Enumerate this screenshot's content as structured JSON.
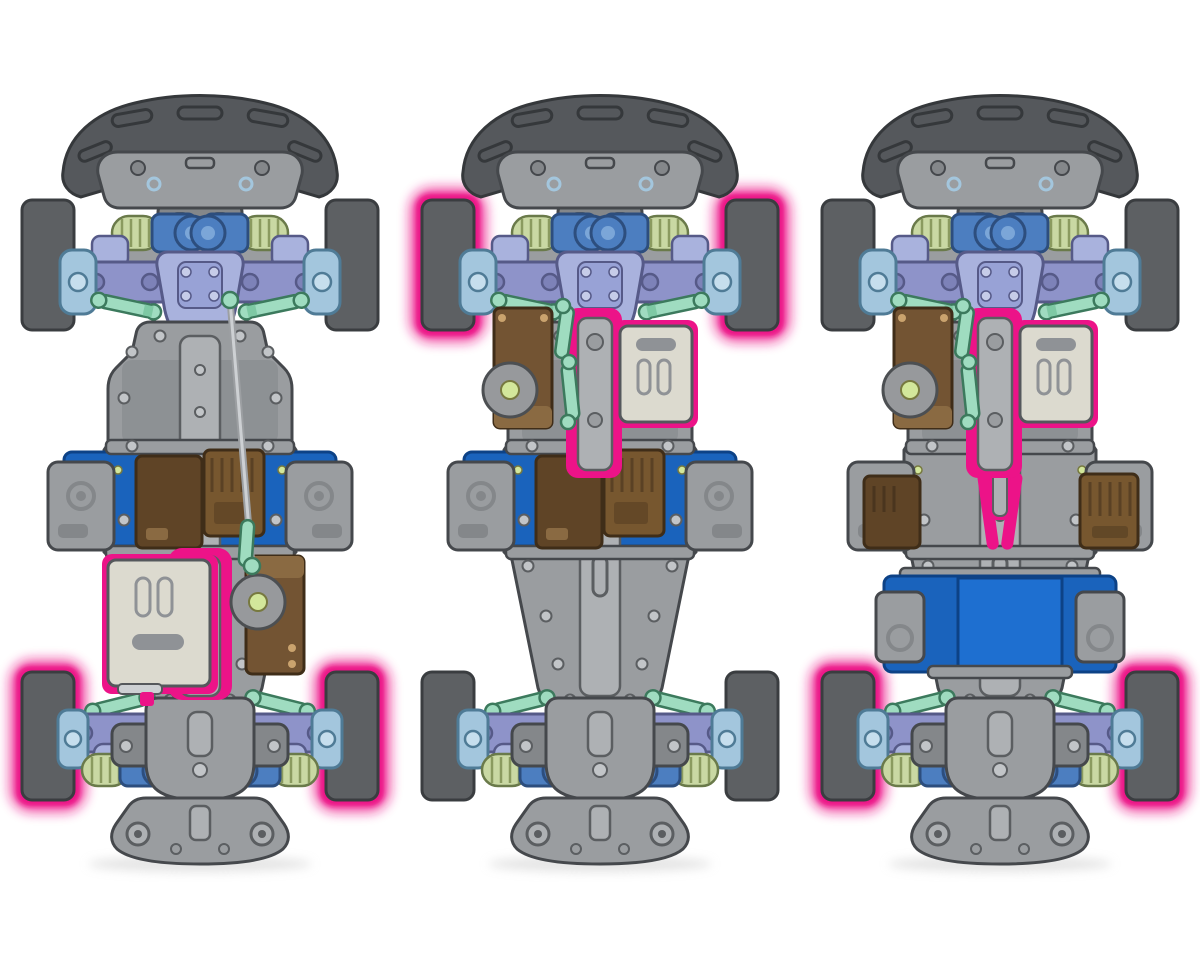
{
  "canvas": {
    "width": 1200,
    "height": 960,
    "background": "#ffffff"
  },
  "figure": {
    "kind": "rc-chassis-drivetrain-layouts",
    "panels": 3
  },
  "palette": {
    "tire": "#5d6063",
    "tire_outline": "#3a3d40",
    "glow": "#ec1388",
    "bumper": "#55585c",
    "bumper_outline": "#35383b",
    "chassis": "#9a9da0",
    "chassis_dark": "#84878a",
    "chassis_light": "#aeb1b4",
    "outline": "#45484c",
    "screw": "#c2c5c8",
    "screw_outline": "#5b5e61",
    "battery": "#1a63bc",
    "battery_bright": "#1e6fd0",
    "battery_dark": "#0d4286",
    "esc_dark": "#5f4426",
    "esc_mid": "#77572f",
    "esc_outline": "#3f2d18",
    "esc_light": "#8a6a42",
    "servo": "#735433",
    "motor": "#dcdacf",
    "motor_outline": "#55585c",
    "motor_vent": "#8f9296",
    "arm_purple": "#8e93c9",
    "arm_purple_dark": "#565a88",
    "arm_bolt": "#7d82b8",
    "periwinkle": "#a9b2dd",
    "periwinkle_deep": "#98a2d6",
    "knuckle_blue": "#a3c6dd",
    "knuckle_outline": "#4f7b96",
    "knuckle_hub": "#c6deed",
    "shock_blue": "#4c7ec0",
    "shock_dark": "#2d4e7e",
    "shock_cap": "#7ba6d8",
    "spring": "#c9d8a3",
    "spring_line": "#8a9a5f",
    "spring_outline": "#6a7a4a",
    "mint": "#9fdcc0",
    "mint_dark": "#3c7a5d",
    "mint_deep": "#7ec9a4",
    "steel": "#9c9fa2",
    "steel_light": "#cdd0d3",
    "led": "#d3e79b",
    "led_ring": "#77793f",
    "shadow": "#c9c9c9"
  },
  "layouts": [
    {
      "id": "layout-rear-motor",
      "position": "left",
      "offset_x": 0,
      "wheels_highlighted": "rear",
      "motor_position": "rear",
      "battery_position": "mid-transverse",
      "servo_side": "right",
      "overlays": [
        "glow-rear",
        "battery-mid",
        "esc-mid",
        "motor-rear",
        "servo-right",
        "rod-long"
      ]
    },
    {
      "id": "layout-front-motor-front-drive",
      "position": "middle",
      "offset_x": 400,
      "wheels_highlighted": "front",
      "motor_position": "front",
      "battery_position": "mid-transverse",
      "servo_side": "left",
      "overlays": [
        "glow-front",
        "battery-mid",
        "esc-mid",
        "motor-front",
        "servo-left",
        "rod-left"
      ]
    },
    {
      "id": "layout-front-motor-rear-drive",
      "position": "right",
      "offset_x": 800,
      "wheels_highlighted": "rear",
      "motor_position": "front",
      "battery_position": "rear-transverse",
      "servo_side": "left",
      "overlays": [
        "glow-rear",
        "battery-rear",
        "esc-sides",
        "motor-front",
        "servo-left",
        "rod-left",
        "shaft-pink"
      ]
    }
  ]
}
